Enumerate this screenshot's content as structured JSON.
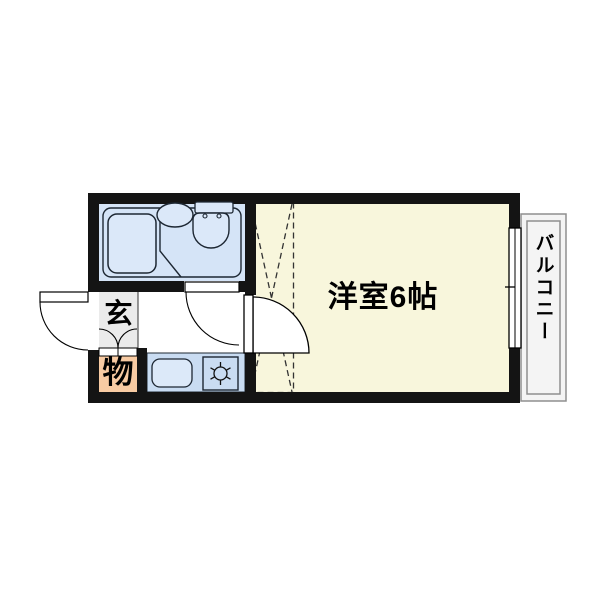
{
  "floorplan": {
    "labels": {
      "main_room": "洋室6帖",
      "balcony": "バルコニー",
      "entrance": "玄",
      "storage": "物"
    },
    "fixtures": [
      "bathtub-icon",
      "washbasin-icon",
      "toilet-icon",
      "kitchen-sink-icon",
      "stove-burner-icon",
      "sliding-window-icon",
      "entrance-door-swing-icon",
      "bathroom-door-swing-icon",
      "room-door-swing-icon",
      "closet-double-door-icon",
      "loft-dashed-outline"
    ],
    "colors": {
      "wall": "#141414",
      "bath": "#d5e4f7",
      "bath_fixture": "#dbe8f9",
      "kitchen": "#c9dcf2",
      "kitchen_fixture": "#dce9f9",
      "main_room": "#f8f6dc",
      "entrance": "#ebebeb",
      "storage": "#f8cba3",
      "balcony_fill": "#f4f4f4",
      "balcony_border": "#8f8f8f",
      "outline": "#1d2733"
    }
  }
}
